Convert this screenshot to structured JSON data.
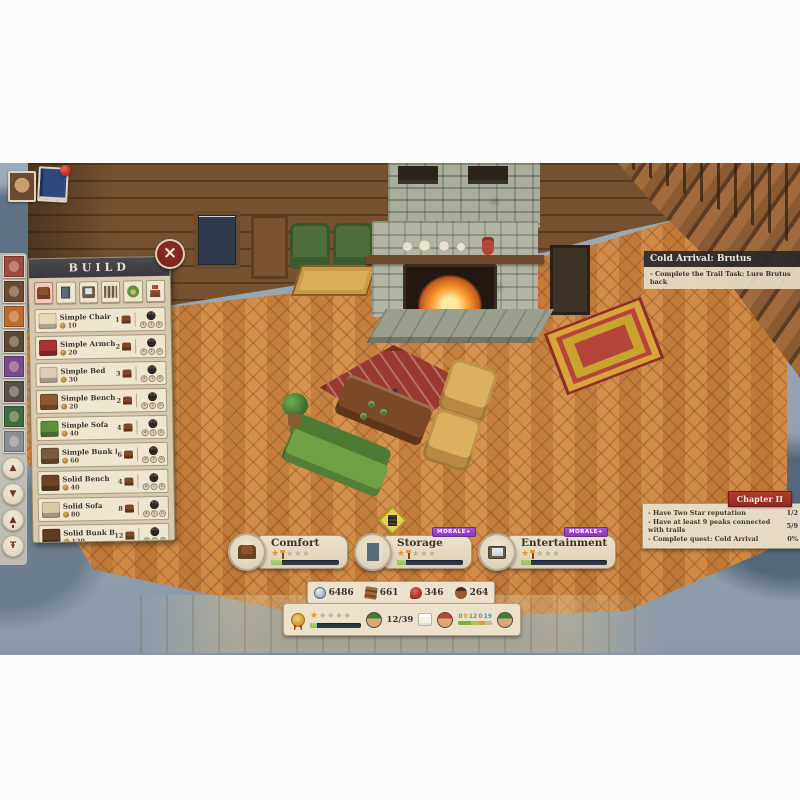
{
  "top_left": {
    "stamps": [
      {
        "id": "bear-album"
      },
      {
        "id": "journal",
        "notification": true
      }
    ]
  },
  "sidebar": {
    "stamps": [
      {
        "id": "red-banner",
        "color": "#9e4a40"
      },
      {
        "id": "bear-head",
        "color": "#6b4a33"
      },
      {
        "id": "hammer",
        "color": "#c06a2e"
      },
      {
        "id": "ranger",
        "color": "#5a4a33"
      },
      {
        "id": "purple-bear",
        "color": "#7a4a8e"
      },
      {
        "id": "cabin",
        "color": "#55504a"
      },
      {
        "id": "shield",
        "color": "#3f6b3f"
      },
      {
        "id": "watchtower",
        "color": "#8a8f96"
      }
    ],
    "buttons": [
      {
        "id": "scroll-up",
        "glyph": "▲"
      },
      {
        "id": "scroll-down",
        "glyph": "▼"
      },
      {
        "id": "tree",
        "glyph": "▲"
      },
      {
        "id": "trail-sign",
        "glyph": "Ŧ"
      }
    ]
  },
  "build_panel": {
    "title": "BUILD",
    "categories": [
      {
        "id": "seating",
        "active": true
      },
      {
        "id": "storage",
        "active": false
      },
      {
        "id": "electronics",
        "active": false
      },
      {
        "id": "fence",
        "active": false
      },
      {
        "id": "decor-head",
        "active": false
      },
      {
        "id": "plants",
        "active": false
      }
    ],
    "craft_dots": [
      "4",
      "1",
      "0"
    ],
    "items": [
      {
        "id": "simple-chair",
        "name": "Simple Chair",
        "price": "10",
        "comfort": "1",
        "thumb": "#e8d9b5"
      },
      {
        "id": "simple-armchair",
        "name": "Simple Armchair",
        "price": "20",
        "comfort": "2",
        "thumb": "#a83434"
      },
      {
        "id": "simple-bed",
        "name": "Simple Bed",
        "price": "30",
        "comfort": "3",
        "thumb": "#d9cdb5"
      },
      {
        "id": "simple-bench",
        "name": "Simple Bench",
        "price": "20",
        "comfort": "2",
        "thumb": "#8a5a33"
      },
      {
        "id": "simple-sofa",
        "name": "Simple Sofa",
        "price": "40",
        "comfort": "4",
        "thumb": "#5e8f3a"
      },
      {
        "id": "simple-bunk-bed",
        "name": "Simple Bunk Bed",
        "price": "60",
        "comfort": "6",
        "thumb": "#7a5a3a"
      },
      {
        "id": "solid-bench",
        "name": "Solid Bench",
        "price": "40",
        "comfort": "4",
        "thumb": "#6b4426"
      },
      {
        "id": "solid-sofa",
        "name": "Solid Sofa",
        "price": "80",
        "comfort": "8",
        "thumb": "#d9c9a5"
      },
      {
        "id": "solid-bunk-bed",
        "name": "Solid Bunk Bed",
        "price": "120",
        "comfort": "12",
        "thumb": "#5e3c22"
      },
      {
        "id": "solid-chair",
        "name": "Solid Chair",
        "price": "20",
        "comfort": "2",
        "thumb": "#e8e0cc"
      }
    ]
  },
  "quest_banner": {
    "title": "Cold Arrival: Brutus",
    "objective": "- Complete the Trail Task: Lure Brutus back"
  },
  "chapter_panel": {
    "title": "Chapter II",
    "objectives": [
      {
        "text": "- Have Two Star reputation",
        "progress": "1/2"
      },
      {
        "text": "- Have at least 9 peaks connected with trails",
        "progress": "5/9"
      },
      {
        "text": "- Complete quest: Cold Arrival",
        "progress": "0%"
      }
    ]
  },
  "stat_bars": [
    {
      "id": "comfort",
      "label": "Comfort",
      "badge": "",
      "fill": "16%"
    },
    {
      "id": "storage",
      "label": "Storage",
      "badge": "MORALE+",
      "fill": "14%"
    },
    {
      "id": "entertainment",
      "label": "Entertainment",
      "badge": "MORALE+",
      "fill": "12%"
    }
  ],
  "resources": [
    {
      "id": "coins",
      "value": "6486"
    },
    {
      "id": "planks",
      "value": "661"
    },
    {
      "id": "food",
      "value": "346"
    },
    {
      "id": "acorns",
      "value": "264"
    }
  ],
  "status_bar": {
    "rating_fill": "14%",
    "guests": "12/39",
    "counters": [
      {
        "value": "0",
        "color": "#6ba03a"
      },
      {
        "value": "0",
        "color": "#c9a22e"
      },
      {
        "value": "12",
        "color": "#6ba03a"
      },
      {
        "value": "0",
        "color": "#8a8578"
      },
      {
        "value": "19",
        "color": "#3a9e9e"
      }
    ],
    "segments": [
      {
        "color": "#7fae3f",
        "width": "38%"
      },
      {
        "color": "#b9c24a",
        "width": "22%"
      },
      {
        "color": "#d0a43a",
        "width": "18%"
      },
      {
        "color": "#bfb9a8",
        "width": "22%"
      }
    ]
  },
  "colors": {
    "accent_red": "#8a2a24",
    "morale_purple": "#9b3fd0",
    "star_orange": "#e8962e",
    "bar_navy": "#2c3a4e",
    "bar_green": "#8fc15c",
    "parchment": "#ece2cc"
  }
}
